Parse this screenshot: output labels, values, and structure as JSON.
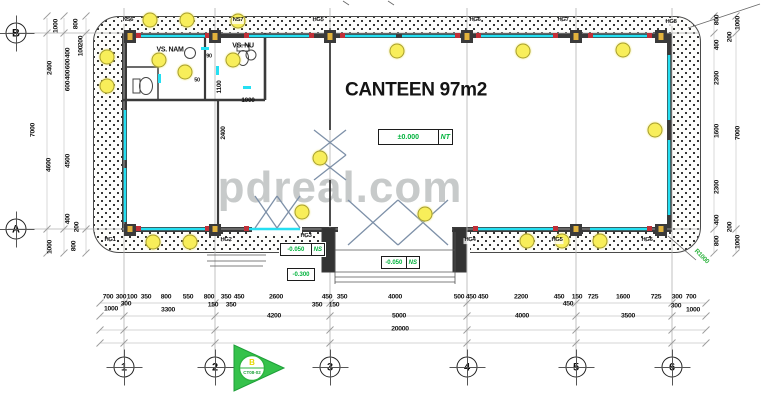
{
  "watermark": "pdreal.com",
  "section_marker": {
    "label": "B",
    "code": "CT08-02"
  },
  "colors": {
    "accent_green": "#00b33c",
    "window_cyan": "#25dff2",
    "light_yellow": "#f8ee5a",
    "wall": "#3a3a3a",
    "watermark_gray": "#9aa0a0"
  },
  "grid": {
    "cols": [
      {
        "label": "1",
        "x": 124
      },
      {
        "label": "2",
        "x": 215
      },
      {
        "label": "3",
        "x": 330
      },
      {
        "label": "4",
        "x": 467
      },
      {
        "label": "5",
        "x": 576
      },
      {
        "label": "6",
        "x": 672
      }
    ],
    "rows": [
      {
        "label": "B",
        "y": 33
      },
      {
        "label": "A",
        "y": 229
      }
    ]
  },
  "texts": [
    {
      "t": "CANTEEN 97m2",
      "x": 416,
      "y": 90,
      "fs": 19,
      "b": 1,
      "name": "room-title"
    },
    {
      "t": "VS. NAM",
      "x": 170,
      "y": 50,
      "fs": 7,
      "b": 1,
      "name": "room-label"
    },
    {
      "t": "VS. NU",
      "x": 243,
      "y": 46,
      "fs": 7,
      "b": 1,
      "name": "room-label"
    },
    {
      "t": "1100",
      "x": 220,
      "y": 87,
      "fs": 6.5,
      "b": 1,
      "rot": -90
    },
    {
      "t": "1000",
      "x": 248,
      "y": 101,
      "fs": 6.5,
      "b": 1
    },
    {
      "t": "90",
      "x": 209,
      "y": 57,
      "fs": 5.5,
      "b": 1
    },
    {
      "t": "50",
      "x": 197,
      "y": 81,
      "fs": 5.5,
      "b": 1
    },
    {
      "t": "2400",
      "x": 224,
      "y": 133,
      "fs": 6.5,
      "b": 1,
      "rot": -90
    },
    {
      "t": "R1000",
      "x": 701,
      "y": 257,
      "fs": 6.5,
      "b": 1,
      "rot": 45,
      "c": "#2db33f",
      "name": "radius-note"
    }
  ],
  "tags": {
    "top": [
      {
        "t": "NS6",
        "x": 128,
        "y": 21
      },
      {
        "t": "NS7",
        "x": 238,
        "y": 21
      },
      {
        "t": "HG5",
        "x": 318,
        "y": 21
      },
      {
        "t": "HG6",
        "x": 475,
        "y": 21
      },
      {
        "t": "HG7",
        "x": 563,
        "y": 21
      },
      {
        "t": "HG8",
        "x": 671,
        "y": 23
      }
    ],
    "bottom": [
      {
        "t": "HG1",
        "x": 110,
        "y": 241
      },
      {
        "t": "HG2",
        "x": 226,
        "y": 241
      },
      {
        "t": "HG3",
        "x": 306,
        "y": 237
      },
      {
        "t": "HG4",
        "x": 470,
        "y": 241
      },
      {
        "t": "HG5",
        "x": 557,
        "y": 241
      },
      {
        "t": "HG6",
        "x": 647,
        "y": 241
      }
    ]
  },
  "dims": {
    "left": [
      {
        "t": "7000",
        "x": 34,
        "y": 130
      },
      {
        "t": "1000",
        "x": 57,
        "y": 26
      },
      {
        "t": "2400",
        "x": 51,
        "y": 68
      },
      {
        "t": "4600",
        "x": 50,
        "y": 165
      },
      {
        "t": "1000",
        "x": 51,
        "y": 247
      },
      {
        "t": "800",
        "x": 77,
        "y": 24
      },
      {
        "t": "200",
        "x": 82,
        "y": 41
      },
      {
        "t": "100",
        "x": 82,
        "y": 51
      },
      {
        "t": "400",
        "x": 69,
        "y": 53
      },
      {
        "t": "600",
        "x": 69,
        "y": 64
      },
      {
        "t": "400",
        "x": 69,
        "y": 75
      },
      {
        "t": "600",
        "x": 69,
        "y": 86
      },
      {
        "t": "4500",
        "x": 69,
        "y": 161
      },
      {
        "t": "400",
        "x": 69,
        "y": 219
      },
      {
        "t": "200",
        "x": 78,
        "y": 227
      },
      {
        "t": "800",
        "x": 75,
        "y": 246
      }
    ],
    "right": [
      {
        "t": "800",
        "x": 718,
        "y": 20
      },
      {
        "t": "1000",
        "x": 739,
        "y": 23
      },
      {
        "t": "200",
        "x": 731,
        "y": 37
      },
      {
        "t": "400",
        "x": 718,
        "y": 45
      },
      {
        "t": "2300",
        "x": 718,
        "y": 78
      },
      {
        "t": "1600",
        "x": 718,
        "y": 131
      },
      {
        "t": "7000",
        "x": 739,
        "y": 133
      },
      {
        "t": "2300",
        "x": 718,
        "y": 187
      },
      {
        "t": "400",
        "x": 718,
        "y": 220
      },
      {
        "t": "200",
        "x": 731,
        "y": 227
      },
      {
        "t": "800",
        "x": 718,
        "y": 241
      },
      {
        "t": "1000",
        "x": 739,
        "y": 242
      }
    ],
    "bottom": [
      {
        "t": "700",
        "x": 108,
        "y": 298
      },
      {
        "t": "300",
        "x": 121,
        "y": 298
      },
      {
        "t": "100",
        "x": 132,
        "y": 298
      },
      {
        "t": "350",
        "x": 146,
        "y": 298
      },
      {
        "t": "800",
        "x": 166,
        "y": 298
      },
      {
        "t": "550",
        "x": 188,
        "y": 298
      },
      {
        "t": "800",
        "x": 209,
        "y": 298
      },
      {
        "t": "350",
        "x": 226,
        "y": 298
      },
      {
        "t": "450",
        "x": 239,
        "y": 298
      },
      {
        "t": "2600",
        "x": 276,
        "y": 298
      },
      {
        "t": "450",
        "x": 327,
        "y": 298
      },
      {
        "t": "350",
        "x": 342,
        "y": 298
      },
      {
        "t": "4000",
        "x": 395,
        "y": 298
      },
      {
        "t": "500",
        "x": 459,
        "y": 298
      },
      {
        "t": "450",
        "x": 471,
        "y": 298
      },
      {
        "t": "450",
        "x": 483,
        "y": 298
      },
      {
        "t": "2200",
        "x": 521,
        "y": 298
      },
      {
        "t": "450",
        "x": 559,
        "y": 298
      },
      {
        "t": "150",
        "x": 577,
        "y": 298
      },
      {
        "t": "725",
        "x": 593,
        "y": 298
      },
      {
        "t": "1600",
        "x": 623,
        "y": 298
      },
      {
        "t": "725",
        "x": 656,
        "y": 298
      },
      {
        "t": "300",
        "x": 677,
        "y": 298
      },
      {
        "t": "700",
        "x": 691,
        "y": 298
      },
      {
        "t": "1000",
        "x": 111,
        "y": 310
      },
      {
        "t": "300",
        "x": 126,
        "y": 305
      },
      {
        "t": "3300",
        "x": 168,
        "y": 311
      },
      {
        "t": "150",
        "x": 213,
        "y": 306
      },
      {
        "t": "350",
        "x": 231,
        "y": 306
      },
      {
        "t": "4200",
        "x": 274,
        "y": 317
      },
      {
        "t": "350",
        "x": 317,
        "y": 306
      },
      {
        "t": "150",
        "x": 334,
        "y": 306
      },
      {
        "t": "5000",
        "x": 399,
        "y": 317
      },
      {
        "t": "4000",
        "x": 522,
        "y": 317
      },
      {
        "t": "450",
        "x": 568,
        "y": 305
      },
      {
        "t": "3500",
        "x": 628,
        "y": 317
      },
      {
        "t": "300",
        "x": 676,
        "y": 307
      },
      {
        "t": "1000",
        "x": 693,
        "y": 311
      },
      {
        "t": "20000",
        "x": 400,
        "y": 330
      }
    ]
  },
  "elevations": [
    {
      "v": "±0.000",
      "tag": "NT",
      "x": 378,
      "y": 129,
      "w": 73,
      "h": 14
    },
    {
      "v": "-0.050",
      "tag": "NS",
      "x": 280,
      "y": 243,
      "w": 43,
      "h": 11
    },
    {
      "v": "-0.300",
      "tag": "",
      "x": 287,
      "y": 268,
      "w": 26,
      "h": 11
    },
    {
      "v": "-0.050",
      "tag": "NS",
      "x": 381,
      "y": 256,
      "w": 37,
      "h": 11
    }
  ],
  "lights": [
    [
      150,
      20
    ],
    [
      187,
      20
    ],
    [
      238,
      21
    ],
    [
      397,
      51
    ],
    [
      523,
      51
    ],
    [
      623,
      50
    ],
    [
      107,
      57
    ],
    [
      107,
      86
    ],
    [
      159,
      60
    ],
    [
      185,
      72
    ],
    [
      233,
      60
    ],
    [
      320,
      158
    ],
    [
      302,
      212
    ],
    [
      425,
      214
    ],
    [
      655,
      130
    ],
    [
      153,
      242
    ],
    [
      190,
      242
    ],
    [
      527,
      241
    ],
    [
      562,
      241
    ],
    [
      600,
      241
    ]
  ]
}
